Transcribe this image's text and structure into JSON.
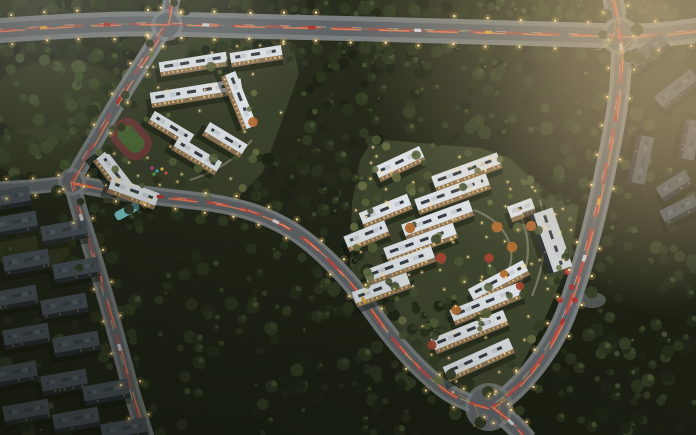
{
  "scene": {
    "width": 696,
    "height": 435,
    "kind": "aerial-dusk-masterplan-render"
  },
  "palette": {
    "bg_top": "#2b2f20",
    "bg_bottom": "#1a1f12",
    "forest_dark": [
      "#1d2416",
      "#242c1a",
      "#2b3420",
      "#323c24"
    ],
    "forest_mid": [
      "#39452a",
      "#42502f",
      "#4b5835"
    ],
    "tree_lit": [
      "#55603a",
      "#676f44"
    ],
    "grass_patch": "#46502e",
    "road_asphalt": "#5f6468",
    "sidewalk": "#82878a",
    "lane_yellow": "#d8b04a",
    "trail_red": "#e0453a",
    "trail_orange": "#ff8a55",
    "headlight": "#ffdfae",
    "light_core": "#ffeec0",
    "light_glow": "#ffc85e",
    "roof_white": "#dce1e5",
    "roof_detail": "#363c42",
    "roof_bump": "#c3cad0",
    "facade_warm": "#8a7354",
    "window_warm": "#ffcf82",
    "old_roof": "#4a525a",
    "old_side": "#262b30",
    "old_bump": "#5a636c",
    "old_window": "#b98f5c",
    "shadow": "#10140c",
    "plate_green": "#39402b",
    "plate_light": "#454c31",
    "track_red": "#6e3d3a",
    "track_green": "#4d6a38",
    "pool_blue": "#7ac9ce",
    "garden_path": "#a9a58e",
    "tree_orange": "#b06a32",
    "tree_red": "#a04530",
    "accent_red": "#a83434",
    "hall_roof": "#ccd2d6",
    "haze_warm": "#d9c093",
    "haze_warm2": "#c9ad85",
    "haze_gray": "#a9a89b",
    "haze_gray2": "#b9b6a6",
    "veh_bus": "#d8a83c",
    "veh_red": "#b03228",
    "veh_white": "#cfd4d8"
  },
  "roads": [
    {
      "name": "top-avenue",
      "d": "M -6,31 C 60,26 120,23 167,24 C 300,27 480,32 620,36 C 650,37 676,33 700,30",
      "w": 15,
      "sw": 25,
      "trail": 1,
      "lane": true,
      "lightStep": 34,
      "treeStep": 24
    },
    {
      "name": "east-arterial",
      "d": "M 612,-6 C 616,14 619,27 620,36 C 625,72 615,125 607,163 C 599,203 588,252 568,308 C 554,347 523,388 492,407",
      "w": 13,
      "sw": 21,
      "trail": 2,
      "lane": true,
      "lightStep": 30,
      "treeStep": 26
    },
    {
      "name": "south-stem",
      "d": "M 492,407 C 505,416 517,427 527,440",
      "w": 13,
      "sw": 21,
      "trail": 2,
      "lane": false,
      "lightStep": 24,
      "treeStep": 0
    },
    {
      "name": "west-diagonal",
      "d": "M 173,-6 C 169,10 170,17 166,25 C 150,52 122,92 98,136 C 88,154 77,170 72,182 C 75,199 84,226 94,258 C 105,294 119,345 131,390 C 136,408 142,424 147,440",
      "w": 10,
      "sw": 17,
      "trail": 1,
      "lane": false,
      "lightStep": 34,
      "treeStep": 26
    },
    {
      "name": "west-spur",
      "d": "M 72,182 C 48,186 20,188 -6,189",
      "w": 9,
      "sw": 15,
      "trail": 0,
      "lane": false,
      "lightStep": 26,
      "treeStep": 0
    },
    {
      "name": "middle-collector",
      "d": "M 72,183 C 125,194 175,198 213,203 C 252,209 283,221 312,245 C 338,267 355,287 374,314 C 393,341 420,372 446,391 C 461,401 476,405 488,408",
      "w": 11,
      "sw": 18,
      "trail": 2,
      "lane": false,
      "lightStep": 30,
      "treeStep": 24
    }
  ],
  "intersections": [
    {
      "x": 167,
      "y": 25,
      "r": 12
    },
    {
      "x": 620,
      "y": 36,
      "r": 15
    },
    {
      "x": 72,
      "y": 182,
      "r": 10
    },
    {
      "x": 489,
      "y": 407,
      "r": 20
    }
  ],
  "lane_arcs": [
    "M 596,50 Q 618,45 615,20",
    "M 648,34 Q 624,40 618,60",
    "M 458,394 Q 488,410 473,427",
    "M 515,387 Q 490,404 505,424"
  ],
  "forests": [
    [
      0,
      0,
      696,
      20,
      120,
      "dark"
    ],
    [
      0,
      38,
      170,
      20,
      30,
      "dark"
    ],
    [
      180,
      40,
      120,
      22,
      26,
      "dark"
    ],
    [
      300,
      44,
      250,
      26,
      40,
      "dark"
    ],
    [
      0,
      55,
      130,
      120,
      55,
      "mid"
    ],
    [
      0,
      175,
      60,
      20,
      10,
      "dark"
    ],
    [
      295,
      62,
      245,
      80,
      90,
      "dark"
    ],
    [
      255,
      140,
      105,
      85,
      45,
      "dark"
    ],
    [
      540,
      55,
      75,
      150,
      45,
      "dark"
    ],
    [
      620,
      100,
      76,
      110,
      25,
      "dark"
    ],
    [
      600,
      225,
      96,
      210,
      70,
      "dark"
    ],
    [
      560,
      330,
      80,
      105,
      30,
      "dark"
    ],
    [
      155,
      245,
      175,
      105,
      60,
      "dark"
    ],
    [
      175,
      350,
      240,
      85,
      65,
      "dark"
    ],
    [
      320,
      255,
      90,
      60,
      30,
      "dark"
    ],
    [
      408,
      296,
      50,
      40,
      14,
      "dark"
    ],
    [
      95,
      205,
      60,
      35,
      14,
      "dark"
    ],
    [
      0,
      215,
      140,
      215,
      42,
      "dark"
    ],
    [
      0,
      425,
      150,
      10,
      8,
      "dark"
    ]
  ],
  "grass_patches": [
    [
      60,
      100,
      70,
      40
    ],
    [
      40,
      152,
      50,
      25
    ],
    [
      30,
      250,
      40,
      20
    ],
    [
      230,
      60,
      60,
      30
    ]
  ],
  "plates": {
    "cluster1": "150,46 292,42 299,74 263,172 233,203 104,203 97,150 113,117 141,60",
    "cluster2": "373,139 480,148 508,158 545,193 578,207 570,260 540,330 513,382 494,401 452,393 404,349 362,300 350,266 352,203 360,160"
  },
  "plate_scatter": {
    "cluster1": {
      "trees": 26,
      "lights": 30
    },
    "cluster2": {
      "trees": 70,
      "lights": 85
    }
  },
  "new_buildings": [
    [
      193,
      62,
      68,
      10,
      -9
    ],
    [
      256,
      54,
      52,
      10,
      -9
    ],
    [
      196,
      91,
      92,
      11,
      -9
    ],
    [
      241,
      100,
      58,
      11,
      68
    ],
    [
      172,
      127,
      46,
      10,
      31
    ],
    [
      198,
      154,
      50,
      11,
      31
    ],
    [
      226,
      138,
      44,
      11,
      31
    ],
    [
      466,
      170,
      70,
      12,
      -20
    ],
    [
      452,
      192,
      76,
      12,
      -20
    ],
    [
      437,
      218,
      72,
      12,
      -20
    ],
    [
      420,
      241,
      74,
      12,
      -20
    ],
    [
      399,
      264,
      72,
      12,
      -20
    ],
    [
      381,
      288,
      58,
      12,
      -20
    ],
    [
      399,
      162,
      50,
      12,
      -25
    ],
    [
      385,
      209,
      52,
      12,
      -22
    ],
    [
      366,
      234,
      44,
      12,
      -22
    ],
    [
      498,
      280,
      62,
      12,
      -28
    ],
    [
      486,
      302,
      74,
      12,
      -22
    ],
    [
      469,
      330,
      78,
      12,
      -22
    ],
    [
      478,
      358,
      72,
      12,
      -24
    ],
    [
      521,
      208,
      26,
      12,
      -20
    ]
  ],
  "hall": [
    553,
    240,
    62,
    20,
    71
  ],
  "old_buildings": [
    [
      12,
      196,
      36,
      15,
      -10
    ],
    [
      14,
      222,
      46,
      15,
      -10
    ],
    [
      64,
      230,
      46,
      15,
      -10
    ],
    [
      26,
      260,
      46,
      15,
      -10
    ],
    [
      76,
      268,
      46,
      15,
      -10
    ],
    [
      14,
      296,
      46,
      15,
      -10
    ],
    [
      64,
      304,
      46,
      15,
      -10
    ],
    [
      26,
      334,
      46,
      15,
      -10
    ],
    [
      76,
      342,
      46,
      15,
      -10
    ],
    [
      14,
      372,
      46,
      15,
      -10
    ],
    [
      64,
      380,
      46,
      15,
      -10
    ],
    [
      106,
      390,
      46,
      15,
      -10
    ],
    [
      26,
      410,
      46,
      15,
      -10
    ],
    [
      76,
      418,
      46,
      15,
      -10
    ],
    [
      124,
      428,
      46,
      15,
      -10
    ],
    [
      648,
      50,
      40,
      13,
      -38
    ],
    [
      676,
      88,
      46,
      13,
      -38
    ],
    [
      643,
      160,
      48,
      13,
      102
    ],
    [
      673,
      184,
      34,
      12,
      -32
    ],
    [
      692,
      140,
      40,
      12,
      102
    ],
    [
      679,
      208,
      38,
      12,
      -26
    ]
  ],
  "school": {
    "track_outer": [
      131,
      139,
      44,
      32,
      48
    ],
    "track_inner": [
      131,
      139,
      30,
      18,
      48
    ],
    "wingA": [
      115,
      172,
      44,
      13,
      52
    ],
    "wingB": [
      134,
      191,
      50,
      13,
      20
    ],
    "pool": [
      127,
      211,
      9,
      26,
      61
    ],
    "playdots": [
      [
        152,
        168,
        "#c84a9a"
      ],
      [
        157,
        171,
        "#48b8c8"
      ],
      [
        162,
        169,
        "#e0c44a"
      ],
      [
        166,
        173,
        "#d05040"
      ],
      [
        154,
        174,
        "#58a858"
      ]
    ]
  },
  "garden": {
    "paths": [
      "M 474,210 C 498,219 514,238 511,261 C 508,278 495,290 480,297",
      "M 518,212 C 529,232 531,254 523,277 C 519,289 509,298 498,303",
      "M 540,200 C 548,230 546,262 532,296",
      "M 190,180 C 215,172 235,160 252,140"
    ],
    "color_trees": [
      [
        497,
        227,
        "o"
      ],
      [
        512,
        247,
        "o"
      ],
      [
        489,
        258,
        "r"
      ],
      [
        520,
        286,
        "r"
      ],
      [
        531,
        226,
        "o"
      ],
      [
        504,
        274,
        "o"
      ],
      [
        253,
        122,
        "o"
      ],
      [
        441,
        258,
        "r"
      ],
      [
        410,
        228,
        "o"
      ],
      [
        456,
        310,
        "o"
      ],
      [
        432,
        345,
        "r"
      ]
    ],
    "plaza": [
      592,
      300,
      14,
      8
    ],
    "accents": [
      [
        561,
        257
      ],
      [
        567,
        272
      ],
      [
        572,
        287
      ],
      [
        560,
        300
      ],
      [
        575,
        300
      ]
    ]
  },
  "vehicles": [
    [
      0,
      0.07,
      "bus"
    ],
    [
      0,
      0.16,
      "red"
    ],
    [
      0,
      0.3,
      "white"
    ],
    [
      0,
      0.45,
      "red"
    ],
    [
      0,
      0.6,
      "white"
    ],
    [
      0,
      0.7,
      "bus"
    ],
    [
      1,
      0.12,
      "white"
    ],
    [
      1,
      0.28,
      "red"
    ],
    [
      1,
      0.47,
      "bus"
    ],
    [
      1,
      0.6,
      "white"
    ],
    [
      1,
      0.75,
      "red"
    ],
    [
      3,
      0.25,
      "red"
    ],
    [
      3,
      0.52,
      "white"
    ],
    [
      3,
      0.8,
      "white"
    ],
    [
      5,
      0.18,
      "red"
    ],
    [
      5,
      0.42,
      "white"
    ],
    [
      5,
      0.66,
      "bus"
    ],
    [
      2,
      0.5,
      "white"
    ]
  ],
  "haze": [
    {
      "cx": 648,
      "cy": 8,
      "r": 300,
      "c": "haze_warm",
      "op": 0.62
    },
    {
      "cx": 690,
      "cy": 120,
      "r": 200,
      "c": "haze_warm2",
      "op": 0.35
    },
    {
      "cx": 40,
      "cy": 5,
      "r": 170,
      "c": "haze_gray",
      "op": 0.33
    },
    {
      "cx": 210,
      "cy": 0,
      "r": 120,
      "c": "haze_gray2",
      "op": 0.22
    }
  ]
}
